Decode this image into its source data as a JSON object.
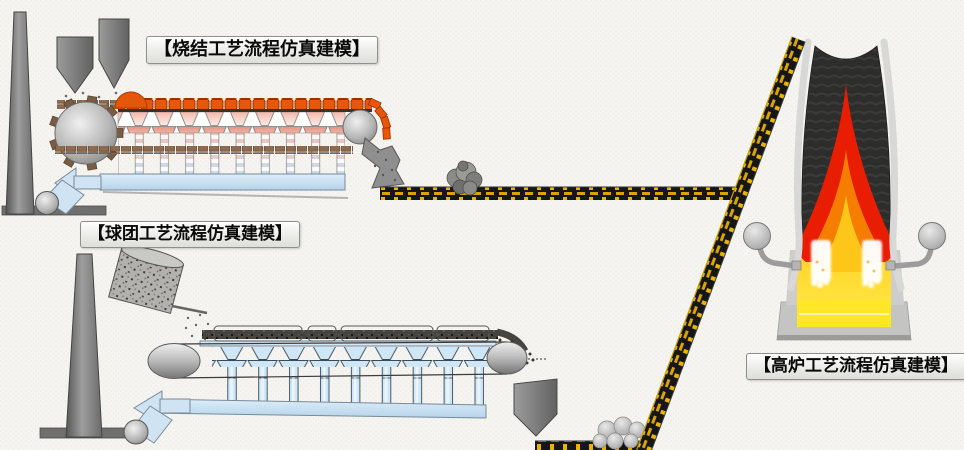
{
  "canvas": {
    "width": 964,
    "height": 450,
    "background": "#f5f4f0"
  },
  "sections": {
    "sinter": {
      "label": "【烧结工艺流程仿真建模】"
    },
    "pellet": {
      "label": "【球团工艺流程仿真建模】"
    },
    "blast_furnace": {
      "label": "【高炉工艺流程仿真建模】"
    }
  },
  "colors": {
    "sinter_hot_material": "#e8560a",
    "ignition_furnace": "#e4560c",
    "windbox_pink": "#e4907e",
    "exhaust_duct_blue": "#cfe3f3",
    "flame_red": "#e81d02",
    "flame_orange": "#f57d00",
    "flame_core_yellow": "#ffc61a",
    "hearth_yellow": "#ffe627",
    "conveyor_yellow": "#e0ac00",
    "conveyor_black": "#161616",
    "machine_gray": "#8a8a8a"
  }
}
